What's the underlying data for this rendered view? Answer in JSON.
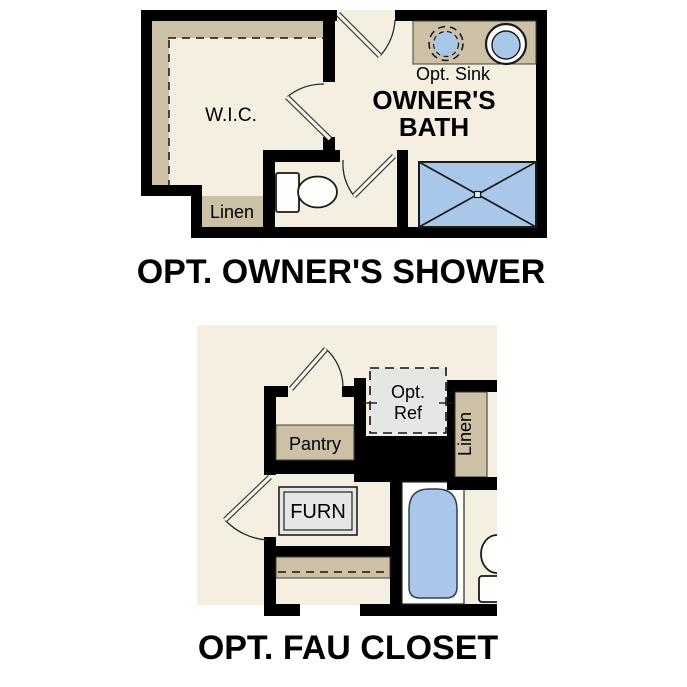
{
  "canvas": {
    "width": 687,
    "height": 687,
    "background": "#ffffff"
  },
  "palette": {
    "floor_cream": "#f5efe2",
    "wall_black": "#000000",
    "shelf_tan": "#ccc0a7",
    "fixture_blue": "#a8c7e9",
    "appliance_gray": "#e4e7e3",
    "outline_dark": "#1a1a1a"
  },
  "plan_top": {
    "title": "OPT. OWNER'S SHOWER",
    "labels": {
      "wic": "W.I.C.",
      "linen": "Linen",
      "opt_sink": "Opt. Sink",
      "bath1": "OWNER'S",
      "bath2": "BATH"
    },
    "fixtures": [
      "optional-sink",
      "sink",
      "toilet",
      "walk-in-shower",
      "closet-shelf-rod",
      "linen-closet"
    ]
  },
  "plan_bottom": {
    "title": "OPT. FAU CLOSET",
    "labels": {
      "pantry": "Pantry",
      "furn": "FURN",
      "ref1": "Opt.",
      "ref2": "Ref",
      "linen": "Linen"
    },
    "fixtures": [
      "optional-refrigerator",
      "furnace-unit",
      "bathtub",
      "toilet",
      "pantry-shelf",
      "closet-shelf-rod",
      "linen-closet"
    ]
  }
}
